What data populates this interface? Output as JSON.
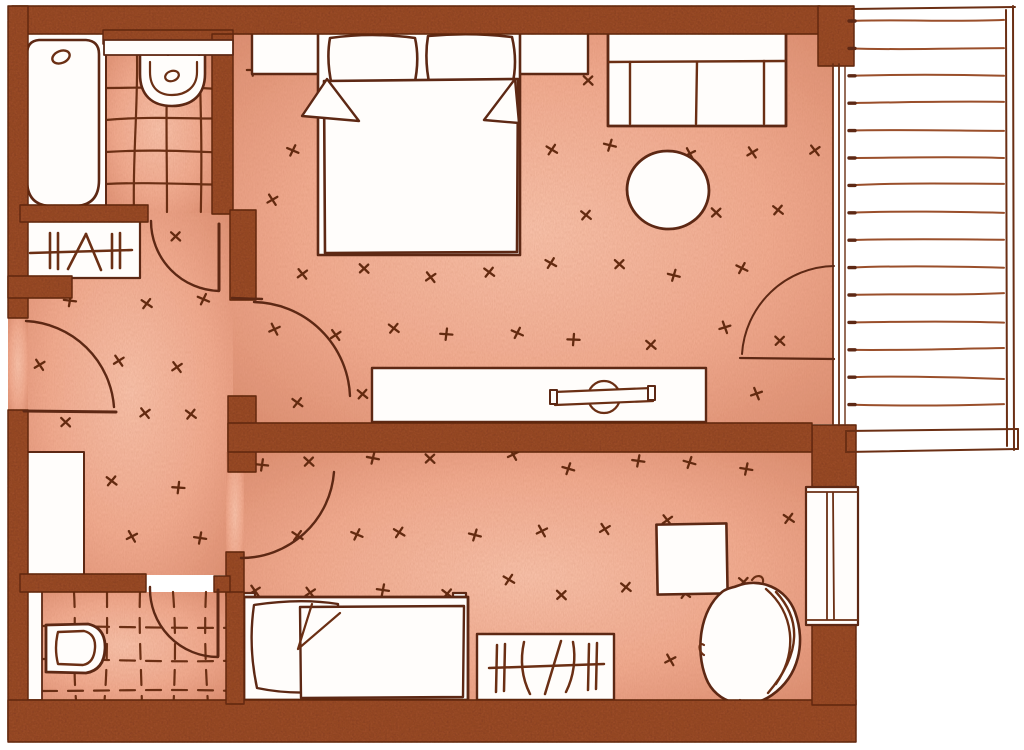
{
  "document": {
    "kind": "hand-drawn apartment floor plan, top-down view, sepia ink on salmon watercolor wash",
    "text_labels": []
  },
  "palette": {
    "paper": "#ffffff",
    "floor_center": "#f7c0a8",
    "floor_mid": "#f0a98e",
    "floor_edge": "#db8d70",
    "wall": "#9c4e29",
    "wall_speckle": "#6e2e12",
    "ink": "#5d2814",
    "line": "#6b2f14",
    "deck_line": "#9a4f2b",
    "deck_tick": "#5d2814",
    "white": "#fffdfb",
    "carpet_mark": "#632a10"
  },
  "rooms": [
    {
      "name": "bathroom",
      "position": "top-left",
      "floor": "tiled",
      "fixtures": [
        "bathtub",
        "washbasin",
        "shelf"
      ]
    },
    {
      "name": "wardrobe-niche",
      "position": "left",
      "fixtures": [
        "wardrobe-with-hangers"
      ]
    },
    {
      "name": "bedroom",
      "position": "top-center",
      "floor": "carpet",
      "furniture": [
        "double-bed",
        "pillow",
        "pillow",
        "duvet-with-folds",
        "headboard-shelf",
        "sofa",
        "round-table",
        "tv-sideboard"
      ]
    },
    {
      "name": "hallway",
      "position": "left-middle",
      "floor": "carpet",
      "furniture": [
        "closet"
      ]
    },
    {
      "name": "second-room",
      "position": "bottom",
      "floor": "carpet",
      "furniture": [
        "single-bed",
        "pillow",
        "duvet",
        "wardrobe-with-hangers",
        "square-side-table",
        "armchair"
      ]
    },
    {
      "name": "wc",
      "position": "bottom-left",
      "floor": "tiled-dashed",
      "fixtures": [
        "toilet",
        "shower-strip"
      ]
    },
    {
      "name": "balcony",
      "position": "right",
      "floor": "wood-decking",
      "planks": 15
    }
  ],
  "doors": [
    "entrance-door",
    "bathroom-door",
    "bedroom-door",
    "second-room-door",
    "wc-door",
    "balcony-glass-door"
  ],
  "windows": [
    "right-wall-window"
  ],
  "decor": {
    "balcony_planks": {
      "count": 15,
      "y0": 21,
      "dy": 27.4,
      "x0": 849,
      "x1": 1004
    },
    "carpet_regions": [
      {
        "x0": 265,
        "y0": 80,
        "x1": 815,
        "y1": 415,
        "step": 64
      },
      {
        "x0": 46,
        "y0": 236,
        "x1": 222,
        "y1": 565,
        "step": 62
      },
      {
        "x0": 256,
        "y0": 464,
        "x1": 800,
        "y1": 690,
        "step": 62
      }
    ],
    "tiles_bathroom": {
      "x0": 106,
      "x1": 212,
      "y0": 56,
      "y1": 212,
      "vx": [
        137,
        168,
        199
      ],
      "hy": [
        88,
        120,
        152,
        184
      ],
      "dash": ""
    },
    "tiles_wc": {
      "x0": 42,
      "x1": 226,
      "y0": 592,
      "y1": 699,
      "vx": [
        74,
        107,
        140,
        173,
        206
      ],
      "hy": [
        626,
        659,
        691
      ],
      "dash": "15 11"
    }
  }
}
